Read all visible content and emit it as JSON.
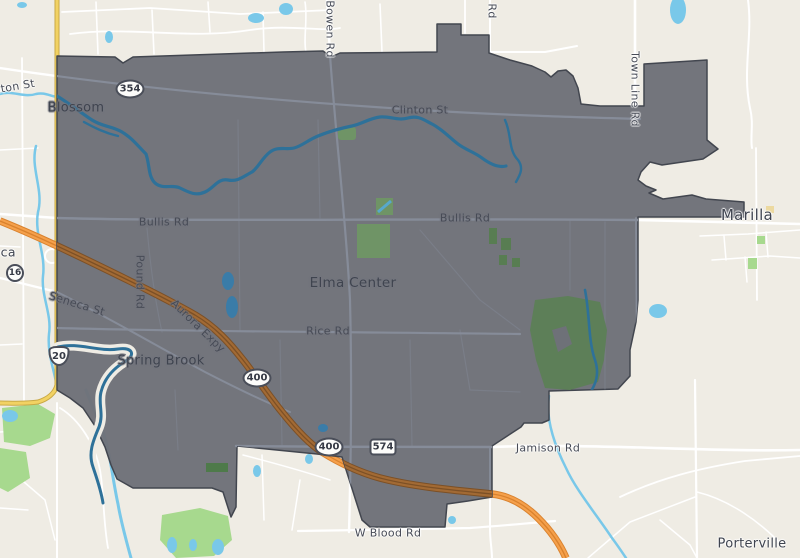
{
  "map": {
    "labels": {
      "towns": [
        {
          "text": "Blossom",
          "x": 76,
          "y": 108,
          "rot": 0,
          "size": 13,
          "inside": true
        },
        {
          "text": "Seneca",
          "x": -8,
          "y": 252,
          "rot": 0,
          "size": 12.5,
          "inside": false
        },
        {
          "text": "Spring Brook",
          "x": 161,
          "y": 361,
          "rot": 0,
          "size": 13,
          "inside": true
        },
        {
          "text": "Elma Center",
          "x": 353,
          "y": 283,
          "rot": 0,
          "size": 13.5,
          "inside": true
        },
        {
          "text": "Marilla",
          "x": 747,
          "y": 215,
          "rot": 0,
          "size": 15,
          "inside": false
        },
        {
          "text": "Porterville",
          "x": 752,
          "y": 544,
          "rot": 0,
          "size": 13,
          "inside": false
        }
      ],
      "roads": [
        {
          "text": "Clinton St",
          "x": 7,
          "y": 88,
          "rot": -10,
          "inside": false
        },
        {
          "text": "Bowen Rd",
          "x": 330,
          "y": 29,
          "rot": 90,
          "inside": false
        },
        {
          "text": "Rd",
          "x": 492,
          "y": 11,
          "rot": 90,
          "inside": false
        },
        {
          "text": "Town Line Rd",
          "x": 635,
          "y": 89,
          "rot": 90,
          "inside": false
        },
        {
          "text": "Clinton St",
          "x": 420,
          "y": 110,
          "rot": 0,
          "inside": true
        },
        {
          "text": "Bullis Rd",
          "x": 164,
          "y": 222,
          "rot": 0,
          "inside": true
        },
        {
          "text": "Bullis Rd",
          "x": 465,
          "y": 218,
          "rot": 0,
          "inside": true
        },
        {
          "text": "Seneca St",
          "x": 77,
          "y": 304,
          "rot": 17,
          "inside": true
        },
        {
          "text": "Pound Rd",
          "x": 140,
          "y": 282,
          "rot": 90,
          "inside": true
        },
        {
          "text": "Aurora Expy",
          "x": 198,
          "y": 326,
          "rot": 44,
          "inside": true
        },
        {
          "text": "Rice Rd",
          "x": 328,
          "y": 331,
          "rot": 0,
          "inside": true
        },
        {
          "text": "Jamison Rd",
          "x": 548,
          "y": 448,
          "rot": 0,
          "inside": false
        },
        {
          "text": "W Blood Rd",
          "x": 388,
          "y": 533,
          "rot": 0,
          "inside": false
        }
      ],
      "shields": [
        {
          "text": "354",
          "kind": "oval",
          "x": 130,
          "y": 89
        },
        {
          "text": "16",
          "kind": "circle",
          "x": 15,
          "y": 273
        },
        {
          "text": "20",
          "kind": "us",
          "x": 59,
          "y": 356
        },
        {
          "text": "400",
          "kind": "oval",
          "x": 257,
          "y": 378
        },
        {
          "text": "400",
          "kind": "oval",
          "x": 329,
          "y": 447
        },
        {
          "text": "574",
          "kind": "rect",
          "x": 383,
          "y": 447
        }
      ]
    },
    "colors": {
      "bg": "#efece4",
      "boundary_fill": "#6e7178",
      "boundary_stroke": "#42464f",
      "road_in": "#868c99",
      "water": "#79c8e9",
      "water_in": "#2e7199",
      "park": "#a7d98e",
      "park_in": "#6f9466",
      "park_in_dark": "#53784e",
      "motorway": "#f5a04b",
      "motorway_casing": "#d9822e",
      "motorway_in": "#a26a34",
      "motorway_in_casing": "#7c5026",
      "yellow_road": "#f2d263",
      "yellow_casing": "#c9a945",
      "label": "#474b56",
      "shield_border": "#4a4e59"
    }
  }
}
